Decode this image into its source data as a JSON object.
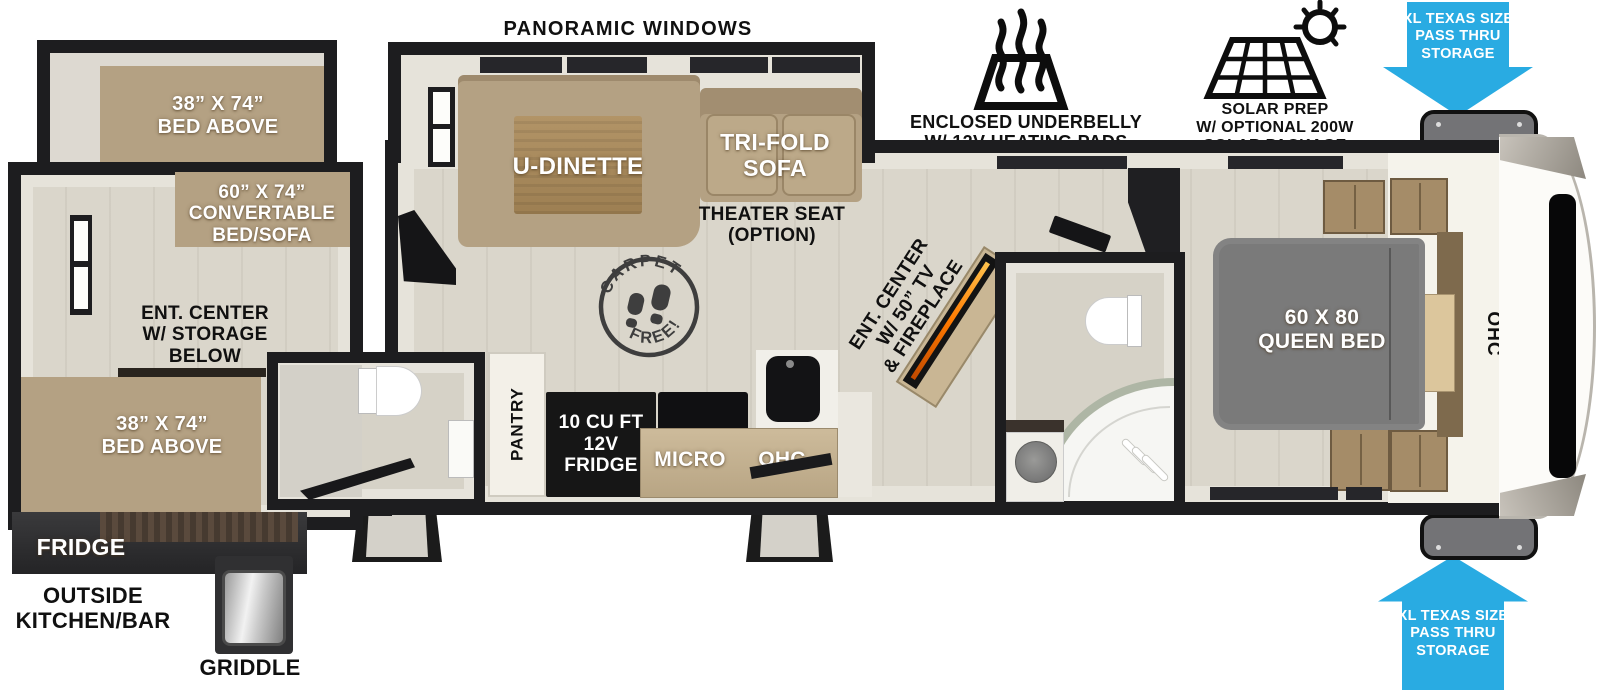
{
  "colors": {
    "arrow_blue": "#29ABE2",
    "wall_black": "#1D1D1F",
    "floor_wood": "#DAD6CB",
    "furniture_tan": "#B4A183",
    "bed_gray": "#7A7A7A",
    "counter_wood": "#C4B190",
    "appliance_black": "#161616",
    "fireplace_flame": "#FF7A00"
  },
  "callouts": {
    "panoramic_windows": "PANORAMIC WINDOWS",
    "underbelly_line1": "ENCLOSED UNDERBELLY",
    "underbelly_line2": "W/ 12V HEATING PADS",
    "solar_line1": "SOLAR PREP",
    "solar_line2": "W/ OPTIONAL 200W",
    "solar_line3": "SOLAR PACKAGE",
    "pass_thru_line1": "XL TEXAS SIZE",
    "pass_thru_line2": "PASS THRU",
    "pass_thru_line3": "STORAGE"
  },
  "exterior": {
    "fridge": "FRIDGE",
    "outside_kitchen_line1": "OUTSIDE",
    "outside_kitchen_line2": "KITCHEN/BAR",
    "griddle": "GRIDDLE"
  },
  "rear_room": {
    "bunk_top_line1": "38” X 74”",
    "bunk_top_line2": "BED ABOVE",
    "convertible_line1": "60” X 74”",
    "convertible_line2": "CONVERTABLE",
    "convertible_line3": "BED/SOFA",
    "ent_center_line1": "ENT. CENTER",
    "ent_center_line2": "W/ STORAGE",
    "ent_center_line3": "BELOW",
    "bunk_bottom_line1": "38” X 74”",
    "bunk_bottom_line2": "BED ABOVE"
  },
  "living": {
    "u_dinette": "U-DINETTE",
    "sofa_line1": "TRI-FOLD",
    "sofa_line2": "SOFA",
    "theater_line1": "THEATER SEAT",
    "theater_line2": "(OPTION)",
    "stamp_top": "CARPET",
    "stamp_bottom": "FREE!",
    "ent_center_line1": "ENT. CENTER",
    "ent_center_line2": "W/ 50” TV",
    "ent_center_line3": "& FIREPLACE"
  },
  "kitchen": {
    "pantry": "PANTRY",
    "fridge_line1": "10 CU FT",
    "fridge_line2": "12V",
    "fridge_line3": "FRIDGE",
    "micro": "MICRO",
    "ohc": "OHC"
  },
  "bedroom": {
    "bed_line1": "60 X 80",
    "bed_line2": "QUEEN BED",
    "ohc": "OHC"
  }
}
